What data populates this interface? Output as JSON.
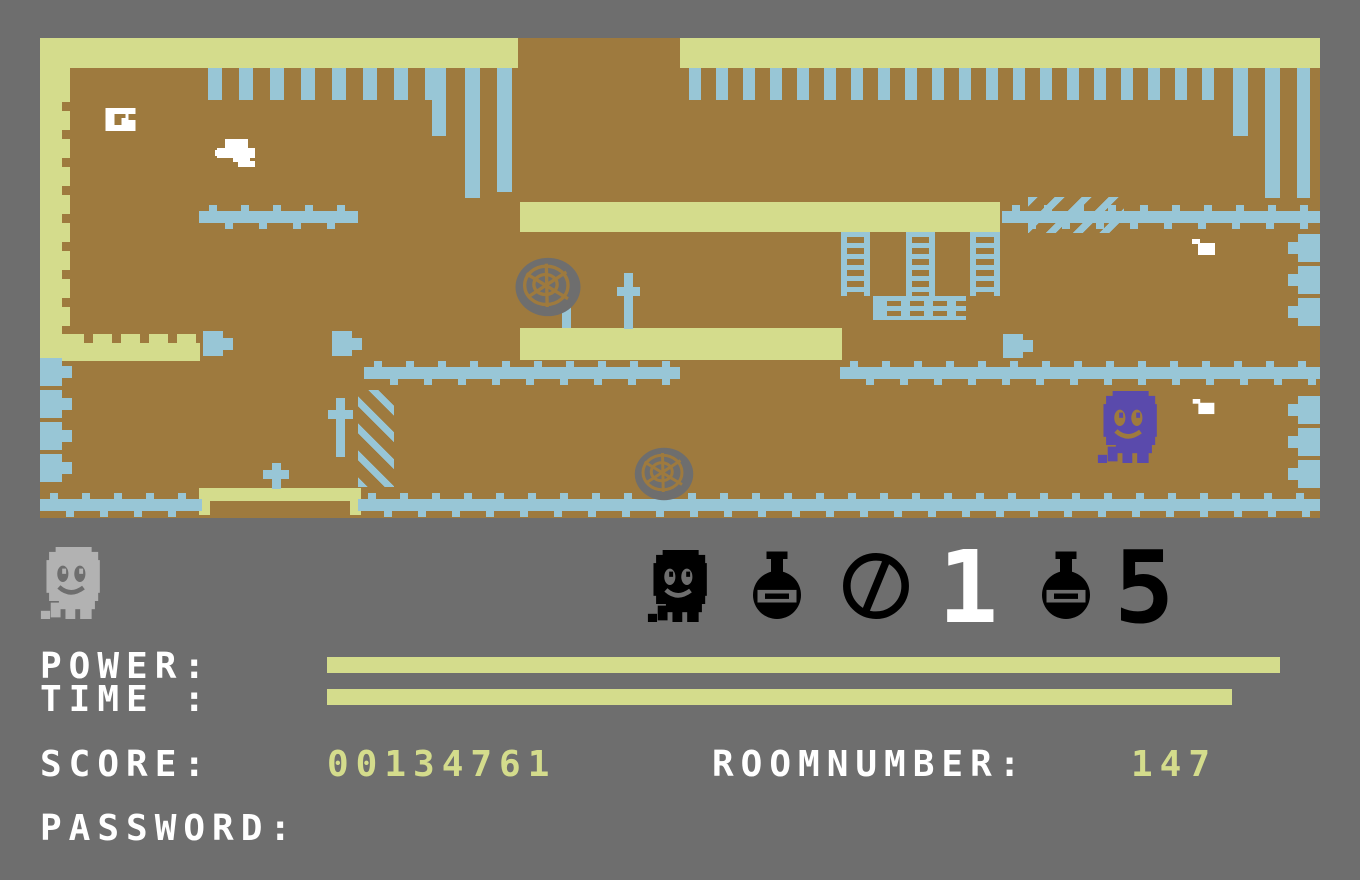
{
  "title": "C64 haunted platformer game screen",
  "colors": {
    "gray": "#6e6e6e",
    "brown": "#9e7a3e",
    "khaki": "#d4dc8c",
    "blue": "#98c6d6",
    "purple": "#5a4aac",
    "lgray": "#b2b2b2",
    "white": "#ffffff",
    "black": "#000000"
  },
  "hud": {
    "labels": {
      "power": "POWER:",
      "time": "TIME :",
      "score": "SCORE:",
      "roomnumber": "ROOMNUMBER:",
      "password": "PASSWORD:"
    },
    "values": {
      "score": "00134761",
      "roomnumber": "147",
      "password": ""
    },
    "counters": {
      "ghost_count": "1",
      "flask_count": "5"
    },
    "icons": [
      "lives-ghost-icon",
      "ghost-icon",
      "flask-icon",
      "no-circle-icon",
      "flask-icon"
    ],
    "meters": {
      "power_width": "953px",
      "time_width": "905px"
    }
  },
  "playfield": {
    "enemies": [
      "purple-ghost",
      "white-bird",
      "white-bird-small",
      "white-bird-small"
    ],
    "items": [
      "white-ring-item"
    ],
    "decor": [
      "grave-cross",
      "grave-cross",
      "grave-cross",
      "grave-cross",
      "web-ball",
      "web-ball",
      "ladders",
      "spiked-bars",
      "hanging-bars",
      "hatched-panels"
    ]
  }
}
